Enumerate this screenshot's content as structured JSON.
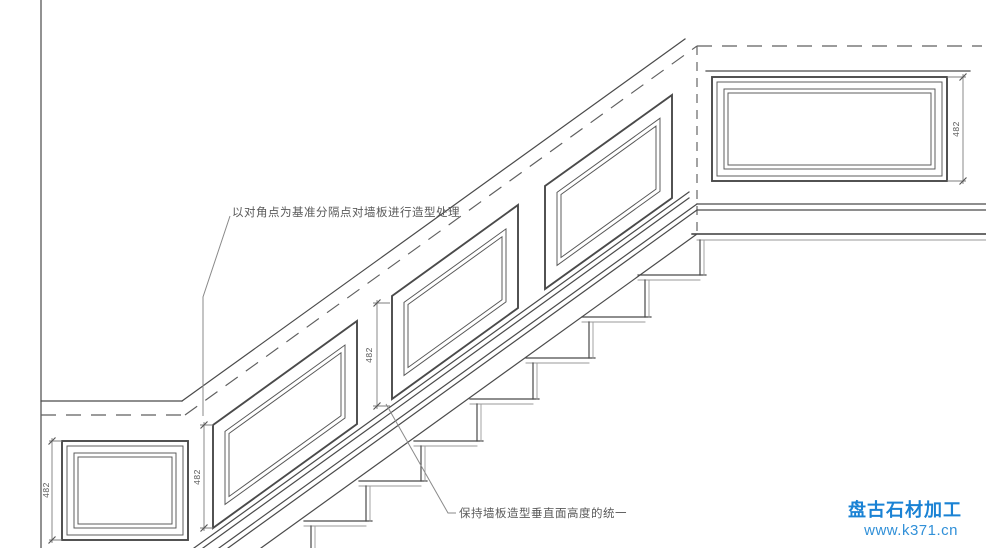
{
  "annotations": {
    "diagonal_reference": "以对角点为基准分隔点对墙板进行造型处理",
    "uniform_height": "保持墙板造型垂直面高度的统一"
  },
  "dimensions": {
    "lower_wall_panel": "482",
    "slope_panel_start": "482",
    "slope_panel_mid": "482",
    "landing_panel": "482"
  },
  "watermark": {
    "brand": "盘古石材加工",
    "site": "www.k371.cn",
    "brand_color": "#1a82d4",
    "site_color": "#3190d8"
  },
  "colors": {
    "line": "#4a4a4a",
    "dimension": "#7d7d7d",
    "background": "#ffffff"
  }
}
